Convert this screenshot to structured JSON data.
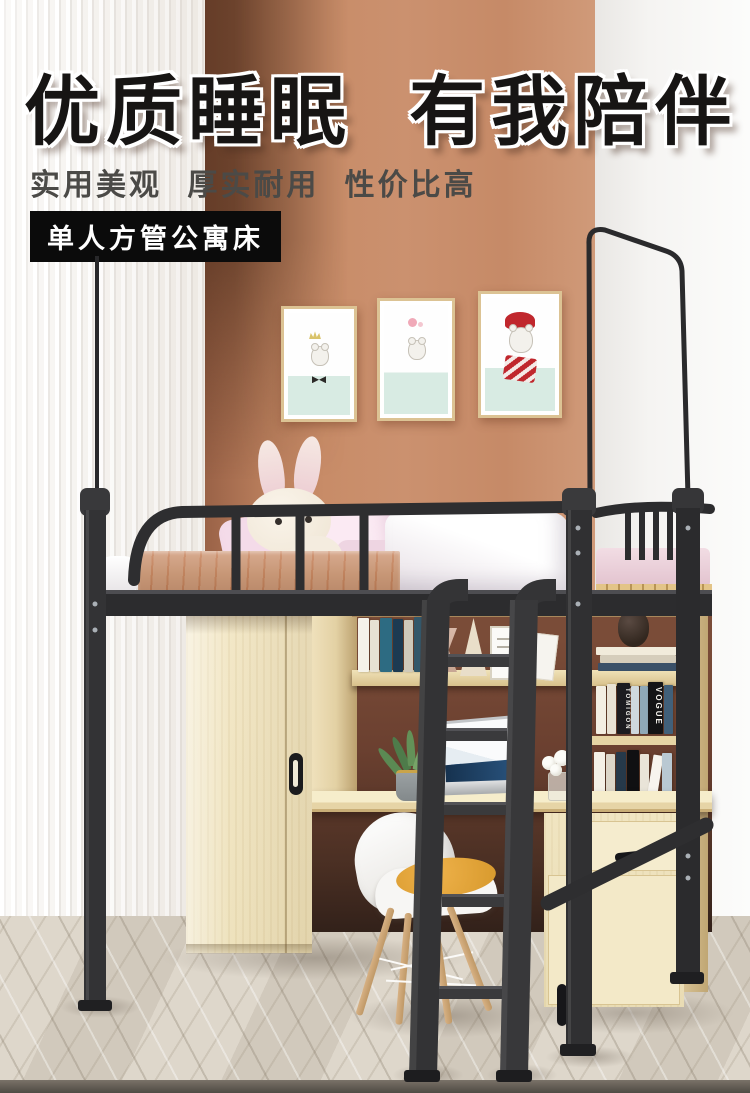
{
  "poster": {
    "headline": "优质睡眠 有我陪伴",
    "subtitle": "实用美观 厚实耐用 性价比高",
    "badge": "单人方管公寓床"
  },
  "scene": {
    "wall_prints": [
      {
        "name": "bear-with-crown-print"
      },
      {
        "name": "bear-with-flower-print"
      },
      {
        "name": "bear-with-red-hat-scarf-print"
      }
    ],
    "books": {
      "spine_1": "TOMIGON",
      "spine_2": "VOGUE"
    }
  },
  "palette": {
    "accent_wall": "#c78e6b",
    "accent_wall_shadow": "#6f4430",
    "side_wall_white": "#f5f4f1",
    "striped_wall": "#f6f4f1",
    "metal_frame": "#2d2d2f",
    "wood_light": "#f0e5c4",
    "bed_side_wood": "#c08a66",
    "floor": "#d9d2c7",
    "cushion_yellow": "#e2a63b",
    "headline_text": "#171514",
    "subtitle_text": "#4b4a47",
    "badge_bg": "#0b0b0b",
    "badge_text": "#ffffff"
  }
}
